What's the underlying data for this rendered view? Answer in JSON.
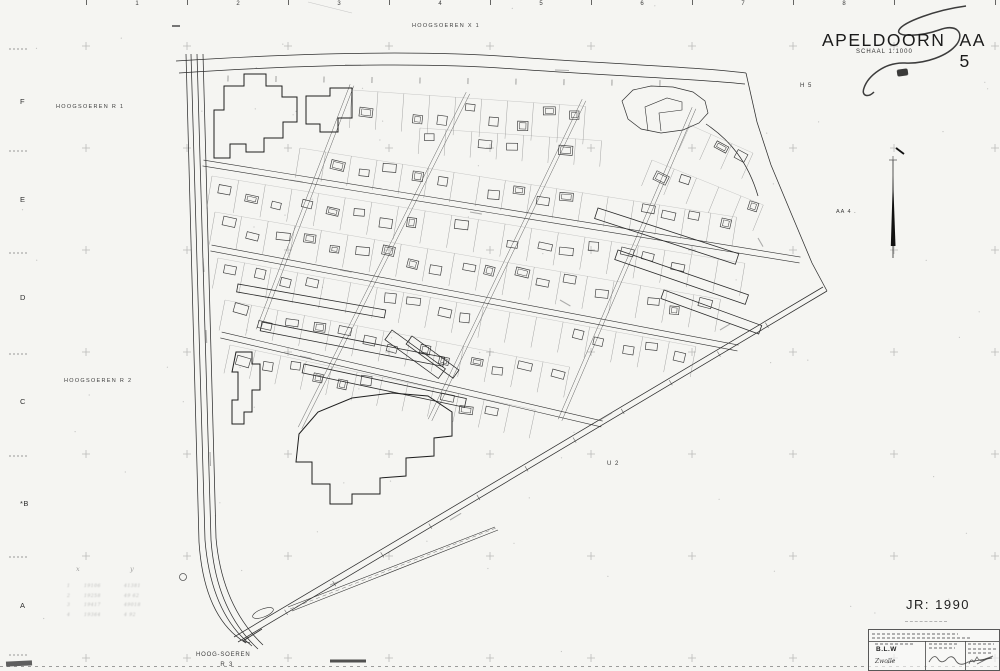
{
  "sheet": {
    "title_word1": "APELDOORN",
    "title_word2": "AA 5",
    "schaal": "SCHAAL 1:1000",
    "year_label": "JR: 1990"
  },
  "top_ruler": {
    "numbers": [
      {
        "t": "1",
        "x": 137
      },
      {
        "t": "2",
        "x": 238
      },
      {
        "t": "3",
        "x": 339
      },
      {
        "t": "4",
        "x": 440
      },
      {
        "t": "5",
        "x": 541
      },
      {
        "t": "6",
        "x": 642
      },
      {
        "t": "7",
        "x": 743
      },
      {
        "t": "8",
        "x": 844
      }
    ],
    "tick_xs": [
      86,
      187,
      288,
      389,
      490,
      591,
      692,
      793,
      894,
      995
    ],
    "dash_mark": {
      "x": 172,
      "y": 25
    }
  },
  "left_ruler": {
    "letters": [
      {
        "t": "F",
        "y": 97
      },
      {
        "t": "E",
        "y": 195
      },
      {
        "t": "D",
        "y": 293
      },
      {
        "t": "C",
        "y": 397
      },
      {
        "t": "*B",
        "y": 499
      },
      {
        "t": "A",
        "y": 601
      }
    ],
    "coord_ys": [
      48,
      150,
      252,
      353,
      455,
      556,
      654
    ]
  },
  "region_labels": {
    "hoogsoeren_x1": "HOOGSOEREN  X 1",
    "hoogsoeren_r1": "HOOGSOEREN  R 1",
    "hoogsoeren_r2": "HOOGSOEREN  R 2",
    "h5": "H 5",
    "aa4": "AA  4  .",
    "u2": "U 2",
    "hoog_soeren": "HOOG-SOEREN",
    "r3": "R 3"
  },
  "pencil_table": {
    "headers": [
      "x",
      "y"
    ],
    "row_markers": [
      "1",
      "2",
      "3",
      "4"
    ],
    "rows_illegible": true,
    "rows": [
      [
        "19106",
        "41381"
      ],
      [
        "19258",
        "49 62"
      ],
      [
        "19417",
        "49018"
      ],
      [
        "19364",
        "4 92"
      ]
    ]
  },
  "title_block": {
    "org": "B.L.W",
    "place": "Zwolle"
  },
  "map": {
    "crosses": {
      "xs": [
        86,
        187,
        288,
        389,
        490,
        591,
        692,
        793,
        894,
        995
      ],
      "ys": [
        46,
        148,
        250,
        352,
        454,
        556,
        658
      ],
      "arm": 4
    },
    "roads": [
      "M176,61 C300,53 420,50 515,57 C610,64 700,67 746,73",
      "M179,73 C300,65 422,62 515,69 C612,76 700,79 745,84",
      "M186,54 L199,542 Q204,618 246,643",
      "M191,54 L205,540 Q211,614 252,646",
      "M197,54 L211,540 Q216,610 258,649",
      "M203,54 L216,538 Q222,606 263,645",
      "M746,73 L757,122 L771,165 L791,213 L812,263 L827,291",
      "M827,291 L238,642",
      "M823,287 L234,637",
      "M706,124 C730,140 748,162 758,196"
    ],
    "road_ticks": [
      {
        "x1": 180,
        "y1": 78,
        "x2": 744,
        "y2": 84,
        "every": 48,
        "len": 3
      },
      {
        "x1": 238,
        "y1": 641,
        "x2": 826,
        "y2": 290,
        "every": 56,
        "len": 3
      }
    ],
    "streets": [
      {
        "x1": 203,
        "y1": 163,
        "x2": 800,
        "y2": 260,
        "gap": 6
      },
      {
        "x1": 211,
        "y1": 248,
        "x2": 738,
        "y2": 348,
        "gap": 6
      },
      {
        "x1": 221,
        "y1": 335,
        "x2": 602,
        "y2": 424,
        "gap": 6
      }
    ],
    "cross_streets": [
      {
        "x1": 352,
        "y1": 85,
        "x2": 258,
        "y2": 330,
        "gap": 4
      },
      {
        "x1": 468,
        "y1": 93,
        "x2": 300,
        "y2": 428,
        "gap": 4
      },
      {
        "x1": 584,
        "y1": 100,
        "x2": 430,
        "y2": 420,
        "gap": 4
      },
      {
        "x1": 694,
        "y1": 108,
        "x2": 560,
        "y2": 420,
        "gap": 4
      }
    ],
    "rows": [
      {
        "x": 352,
        "y": 90,
        "ang": 4,
        "count": 9,
        "step": 26,
        "depth": 38
      },
      {
        "x": 420,
        "y": 128,
        "ang": 4,
        "count": 7,
        "step": 26,
        "depth": 26
      },
      {
        "x": 300,
        "y": 148,
        "ang": 9,
        "count": 17,
        "step": 26,
        "depth": 30
      },
      {
        "x": 212,
        "y": 176,
        "ang": 9.3,
        "count": 20,
        "step": 27,
        "depth": 33
      },
      {
        "x": 215,
        "y": 212,
        "ang": 9.8,
        "count": 19,
        "step": 27,
        "depth": 33
      },
      {
        "x": 218,
        "y": 258,
        "ang": 10.5,
        "count": 18,
        "step": 27,
        "depth": 31
      },
      {
        "x": 225,
        "y": 300,
        "ang": 11,
        "count": 13,
        "step": 27,
        "depth": 31
      },
      {
        "x": 230,
        "y": 345,
        "ang": 12,
        "count": 12,
        "step": 26,
        "depth": 29
      },
      {
        "x": 690,
        "y": 125,
        "ang": 24,
        "count": 3,
        "step": 23,
        "depth": 28
      },
      {
        "x": 652,
        "y": 160,
        "ang": 22,
        "count": 5,
        "step": 24,
        "depth": 28
      }
    ],
    "buildings_big": [
      "214,152 214,110 224,110 224,86 244,86 244,74 266,74 266,86 282,86 282,97 297,97 297,122 283,122 283,138 264,138 264,152 246,152 246,144 230,144 230,158 214,158",
      "306,112 306,96 330,96 330,88 352,88 352,118 338,118 338,132 320,132 320,124 306,124",
      "299,434 318,412 352,398 392,393 428,396 452,412 452,436 434,438 434,456 406,458 406,476 380,478 380,494 352,494 352,504 330,504 330,484 312,484 312,462 296,462",
      "236,352 252,352 252,364 260,364 260,390 252,390 252,412 244,412 244,424 232,424 232,400 238,400 238,372 232,372"
    ],
    "buildings_long": [
      {
        "x": 238,
        "y": 284,
        "w": 150,
        "h": 8,
        "r": 10
      },
      {
        "x": 262,
        "y": 322,
        "w": 186,
        "h": 9,
        "r": 11
      },
      {
        "x": 304,
        "y": 364,
        "w": 166,
        "h": 9,
        "r": 12
      },
      {
        "x": 598,
        "y": 208,
        "w": 148,
        "h": 11,
        "r": 18
      },
      {
        "x": 618,
        "y": 250,
        "w": 138,
        "h": 10,
        "r": 19
      },
      {
        "x": 664,
        "y": 290,
        "w": 104,
        "h": 9,
        "r": 20
      },
      {
        "x": 392,
        "y": 330,
        "w": 66,
        "h": 12,
        "r": 36
      },
      {
        "x": 412,
        "y": 336,
        "w": 58,
        "h": 10,
        "r": 36
      }
    ],
    "blob": {
      "outer": "622,101 633,90 651,86 673,87 693,92 705,101 708,113 699,123 683,130 661,133 641,129 628,119",
      "notch": "648,131 645,107 667,98 682,102 682,110 659,113 661,131"
    },
    "strip": {
      "lines": [
        "M288,607 L495,527",
        "M292,611 L498,530"
      ],
      "center": "M290,609 L496,528",
      "ellipse": {
        "cx": 263,
        "cy": 613,
        "rx": 11,
        "ry": 4,
        "rot": -21
      }
    },
    "north_arrow": {
      "shaft": "M893,160 L893,258",
      "blade": "890.8,246 893,176 895.5,246",
      "dash": "M896,148 L904,154"
    },
    "flourish": "M966,6 C936,10 903,22 899,30 C895,38 922,36 939,30 C958,23 964,34 957,44 C948,56 925,64 905,63 C885,62 868,76 864,88 C861,96 868,98 874,92",
    "pen": {
      "arrow": {
        "line": "M262,629 L243,641",
        "h1": "M243,641 L249,637",
        "h2": "M243,641 L250,643"
      },
      "circle": {
        "cx": 183,
        "cy": 577,
        "r": 3.5
      }
    },
    "smudges": [
      {
        "x": 345,
        "y": 65,
        "len": 16,
        "r": 1
      },
      {
        "x": 555,
        "y": 70,
        "len": 14,
        "r": 2
      },
      {
        "x": 203,
        "y": 258,
        "len": 14,
        "r": 86
      },
      {
        "x": 206,
        "y": 330,
        "len": 13,
        "r": 87
      },
      {
        "x": 210,
        "y": 452,
        "len": 14,
        "r": 88
      },
      {
        "x": 290,
        "y": 180,
        "len": 13,
        "r": 9
      },
      {
        "x": 340,
        "y": 270,
        "len": 12,
        "r": 10
      },
      {
        "x": 300,
        "y": 356,
        "len": 12,
        "r": 12
      },
      {
        "x": 470,
        "y": 212,
        "len": 12,
        "r": 10
      },
      {
        "x": 560,
        "y": 300,
        "len": 12,
        "r": 30
      },
      {
        "x": 600,
        "y": 420,
        "len": 14,
        "r": -31
      },
      {
        "x": 450,
        "y": 520,
        "len": 13,
        "r": -31
      },
      {
        "x": 330,
        "y": 585,
        "len": 12,
        "r": -21
      },
      {
        "x": 720,
        "y": 330,
        "len": 12,
        "r": -31
      },
      {
        "x": 758,
        "y": 238,
        "len": 10,
        "r": 60
      }
    ],
    "artifacts": {
      "bottom_dash_y": 666.5,
      "dark_seg": "M330,661 L366,661",
      "scratch": "M308,2 L352,13"
    }
  }
}
